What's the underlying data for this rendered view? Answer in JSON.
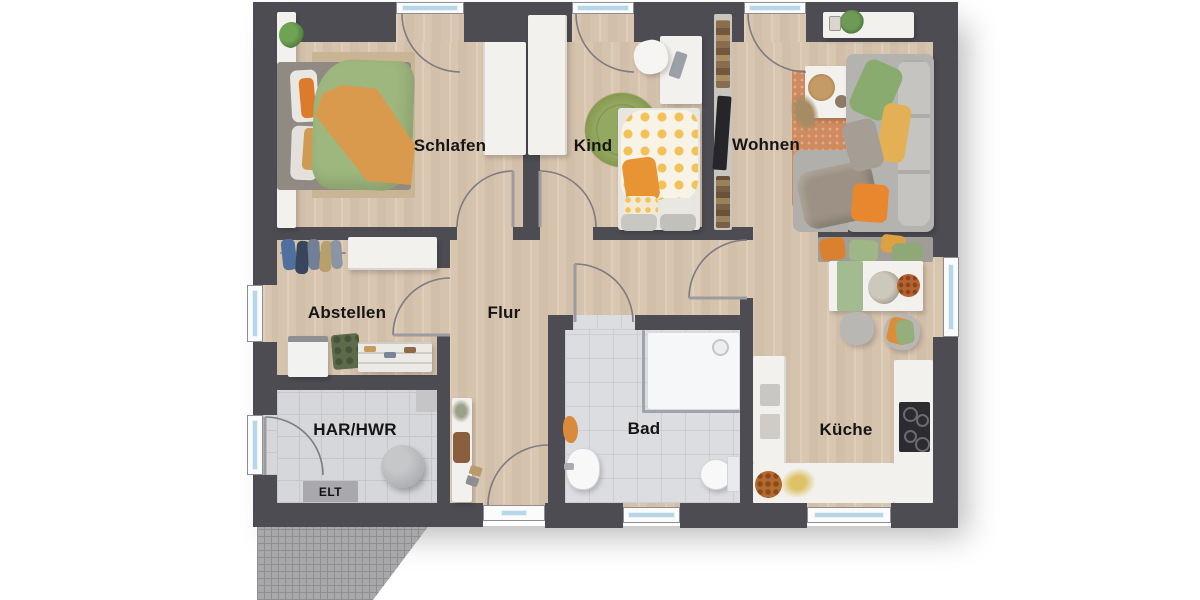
{
  "plan": {
    "type": "floor_plan",
    "rooms": [
      {
        "id": "schlafen",
        "label": "Schlafen"
      },
      {
        "id": "kind",
        "label": "Kind"
      },
      {
        "id": "wohnen",
        "label": "Wohnen"
      },
      {
        "id": "abstellen",
        "label": "Abstellen"
      },
      {
        "id": "flur",
        "label": "Flur"
      },
      {
        "id": "bad",
        "label": "Bad"
      },
      {
        "id": "kueche",
        "label": "Küche"
      },
      {
        "id": "har_hwr",
        "label": "HAR/HWR"
      }
    ],
    "annotations": [
      {
        "id": "elt",
        "label": "ELT"
      }
    ],
    "icons": [
      "window-symbol",
      "entry-door-symbol",
      "door-swing-arc",
      "cooktop-icon",
      "shower-icon",
      "toilet-icon",
      "sink-icon"
    ],
    "colors": {
      "wall": "#4c4c52",
      "wood_floor": "#d3c0ab",
      "tile_floor": "#dcdde0",
      "window_glass": "#b7d7e9",
      "terrace_hatch": "#a8a8ab",
      "accent_orange": "#dd8a3a",
      "accent_green": "#9eb77e",
      "rug_terracotta": "#d08a5f",
      "sofa_gray": "#b5b3b0"
    }
  }
}
